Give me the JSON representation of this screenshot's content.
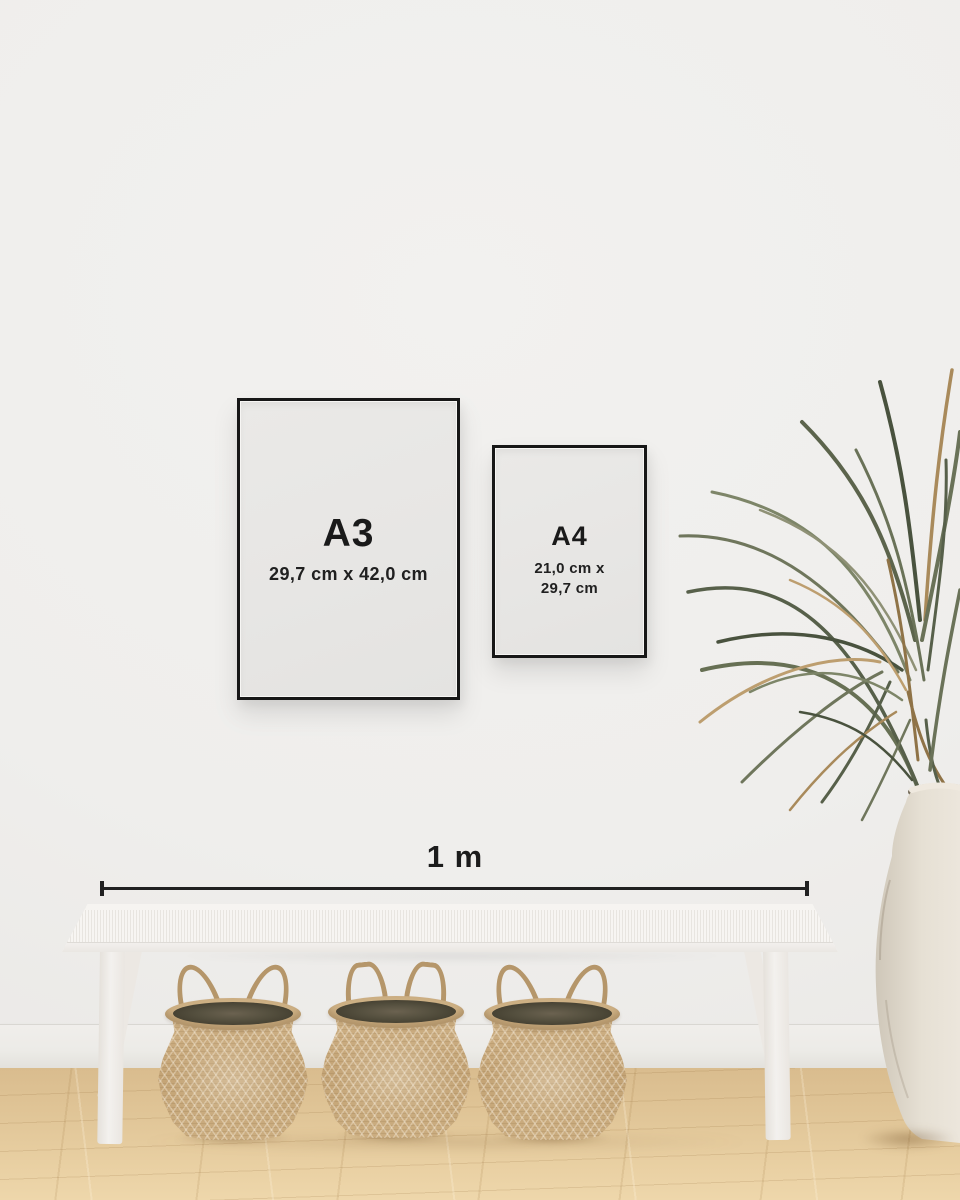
{
  "frames": [
    {
      "id": "a3",
      "label": "A3",
      "dimensions": "29,7 cm x 42,0 cm"
    },
    {
      "id": "a4",
      "label": "A4",
      "dimensions_line1": "21,0 cm x",
      "dimensions_line2": "29,7 cm"
    }
  ],
  "scale_bar": {
    "label": "1 m"
  },
  "colors": {
    "frame_border": "#171717",
    "poster_paper": "#e7e6e4",
    "text": "#1a1a1a",
    "wall": "#efeeec",
    "baseboard": "#ecebe7",
    "floor_wood": "#e0c597",
    "bench_white": "#f4f2ef",
    "basket_weave": "#c9aa7e",
    "basket_opening": "#55503f",
    "plant_green": "#5c644c",
    "plant_dried": "#ab8a5f",
    "vase": "#e8e2d8",
    "measure_line": "#212121"
  }
}
